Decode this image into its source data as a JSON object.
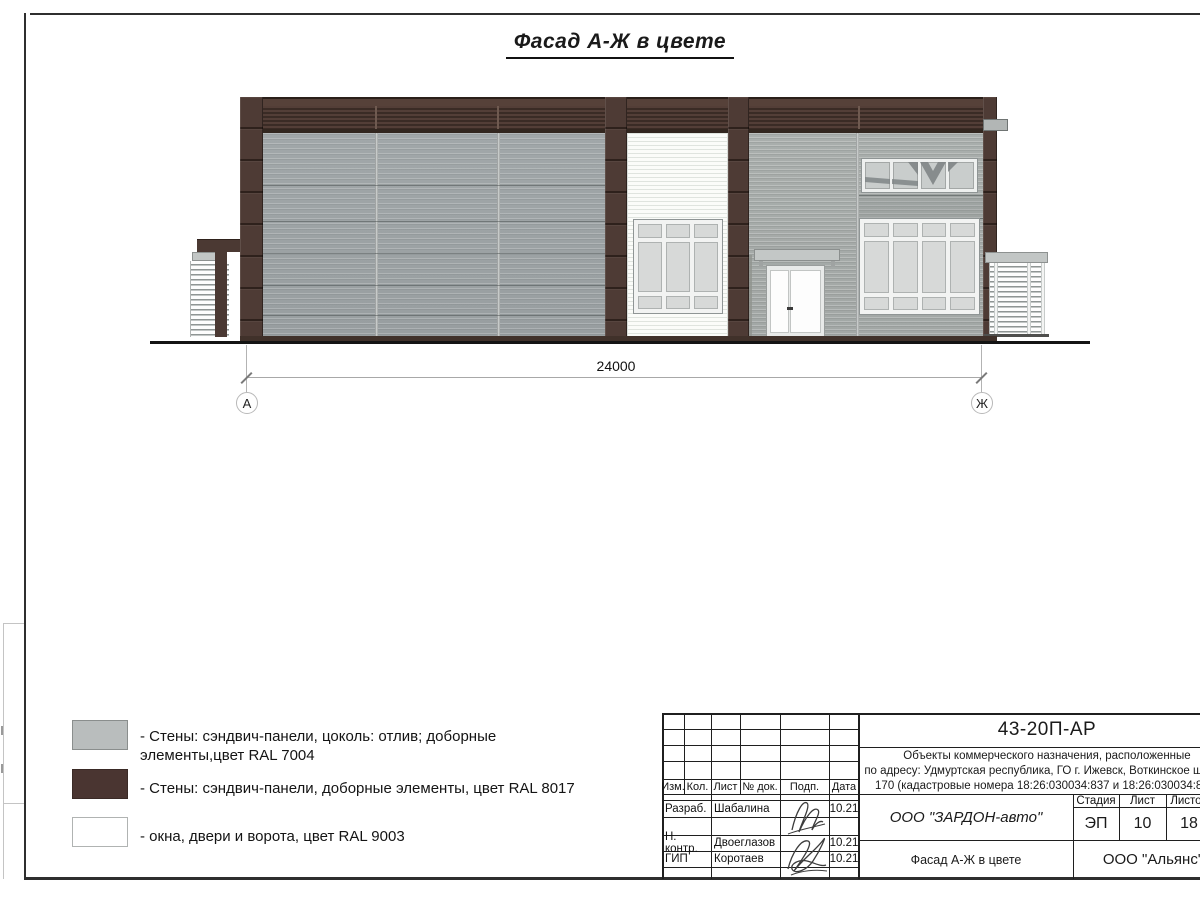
{
  "sheet": {
    "title": "Фасад А-Ж в цвете"
  },
  "facade": {
    "dimension_label": "24000",
    "axis_left": "А",
    "axis_right": "Ж"
  },
  "legend": {
    "items": [
      {
        "swatch_color": "#b9bdbd",
        "line1": "- Стены: сэндвич-панели, цоколь: отлив; доборные",
        "line2": "элементы,цвет RAL 7004"
      },
      {
        "swatch_color": "#4a3531",
        "line1": "- Стены: сэндвич-панели, доборные элементы, цвет RAL 8017"
      },
      {
        "swatch_color": "#ffffff",
        "line1": "- окна, двери и ворота, цвет RAL 9003"
      }
    ]
  },
  "title_block": {
    "doc_number": "43-20П-АР",
    "description": [
      "Объекты коммерческого назначения, расположенные",
      "по адресу: Удмуртская республика, ГО г. Ижевск, Воткинское шоссе,",
      "170 (кадастровые номера 18:26:030034:837 и 18:26:030034:838)"
    ],
    "columns": [
      "Изм.",
      "Кол.",
      "Лист",
      "№ док.",
      "Подп.",
      "Дата"
    ],
    "personnel": [
      {
        "role": "Разраб.",
        "name": "Шабалина",
        "date": "10.21"
      },
      {
        "role": "Н. контр.",
        "name": "Двоеглазов",
        "date": "10.21"
      },
      {
        "role": "ГИП",
        "name": "Коротаев",
        "date": "10.21"
      }
    ],
    "organization": "ООО \"ЗАРДОН-авто\"",
    "stage_label": "Стадия",
    "sheet_label": "Лист",
    "sheets_label": "Листов",
    "stage": "ЭП",
    "sheet_number": "10",
    "sheets_total": "18",
    "drawing_name": "Фасад А-Ж в цвете",
    "company": "ООО \"Альянс\""
  },
  "colors": {
    "ral_7004_gray": "#b9bdbd",
    "ral_8017_brown": "#4a3531",
    "ral_9003_white": "#ffffff",
    "wall_gray": "#9da3a4",
    "line_black": "#1a1a1a"
  }
}
